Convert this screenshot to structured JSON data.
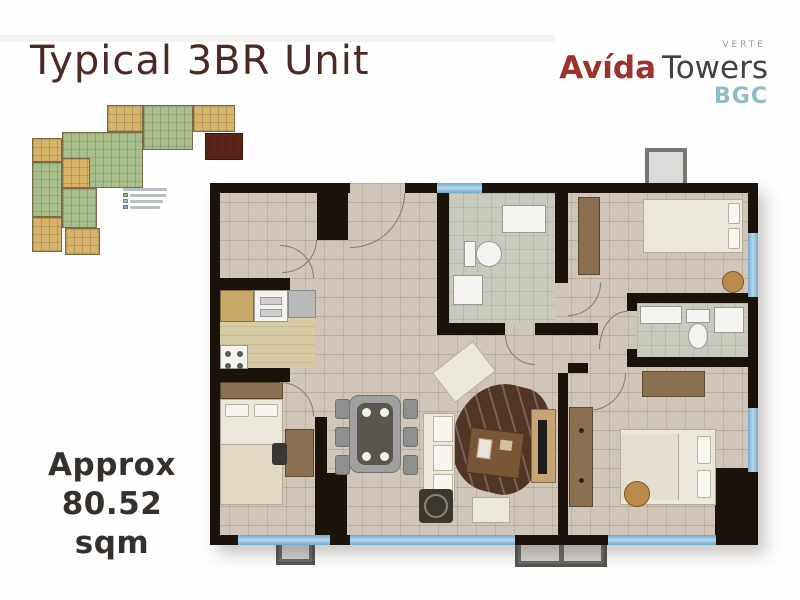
{
  "page": {
    "title": "Typical 3BR Unit"
  },
  "logo": {
    "brand": "Avída",
    "suffix": "Towers",
    "sub_label": "VERTE",
    "location": "BGC"
  },
  "area": {
    "line1": "Approx",
    "line2": "80.52 sqm"
  },
  "colors": {
    "c-title": "#4b2a24",
    "c-brand": "#9b332c",
    "c-brand2": "#454140",
    "c-sub": "#9a9896",
    "c-loc": "#8dbcc6",
    "c-wall": "#1b120b",
    "c-floor": "#cfc5b8",
    "c-window": "#7fb2d8",
    "c-area": "#35302c",
    "c-bath": "#c7cabc",
    "c-kitchen": "#d6cba5",
    "c-maroon": "#5a1f16",
    "c-kp-green": "#a8bf8d",
    "c-kp-tan": "#d8b36a"
  },
  "keyplan": {
    "legend_swatches": [
      "#8fbc74",
      "#a9c4bd",
      "#7fb2d9"
    ]
  }
}
